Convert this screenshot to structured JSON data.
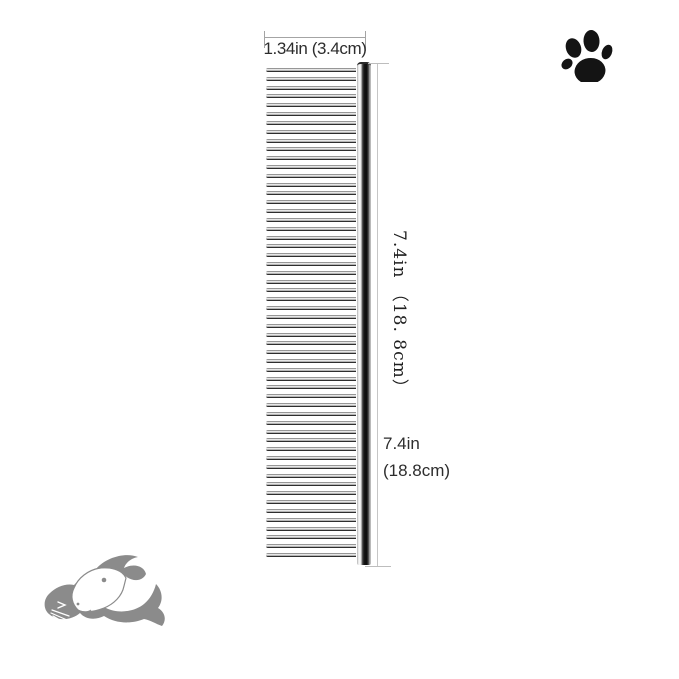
{
  "page": {
    "background_color": "#ffffff",
    "text_color": "#2d2d2d",
    "dimension_line_color": "#c6c6c6"
  },
  "annotations": {
    "width_label": "1.34in (3.4cm)",
    "length_label_vertical": "7.4in （18. 8cm）",
    "length_label_line1": "7.4in",
    "length_label_line2": "(18.8cm)"
  },
  "comb": {
    "teeth_count": 56,
    "teeth_span_px": 489,
    "metal_dark": "#161616",
    "metal_light": "#fafafa"
  },
  "icons": [
    {
      "name": "paw-print-icon",
      "color": "#141414"
    },
    {
      "name": "dog-cat-logo-icon",
      "color": "#8b8b8b"
    }
  ]
}
